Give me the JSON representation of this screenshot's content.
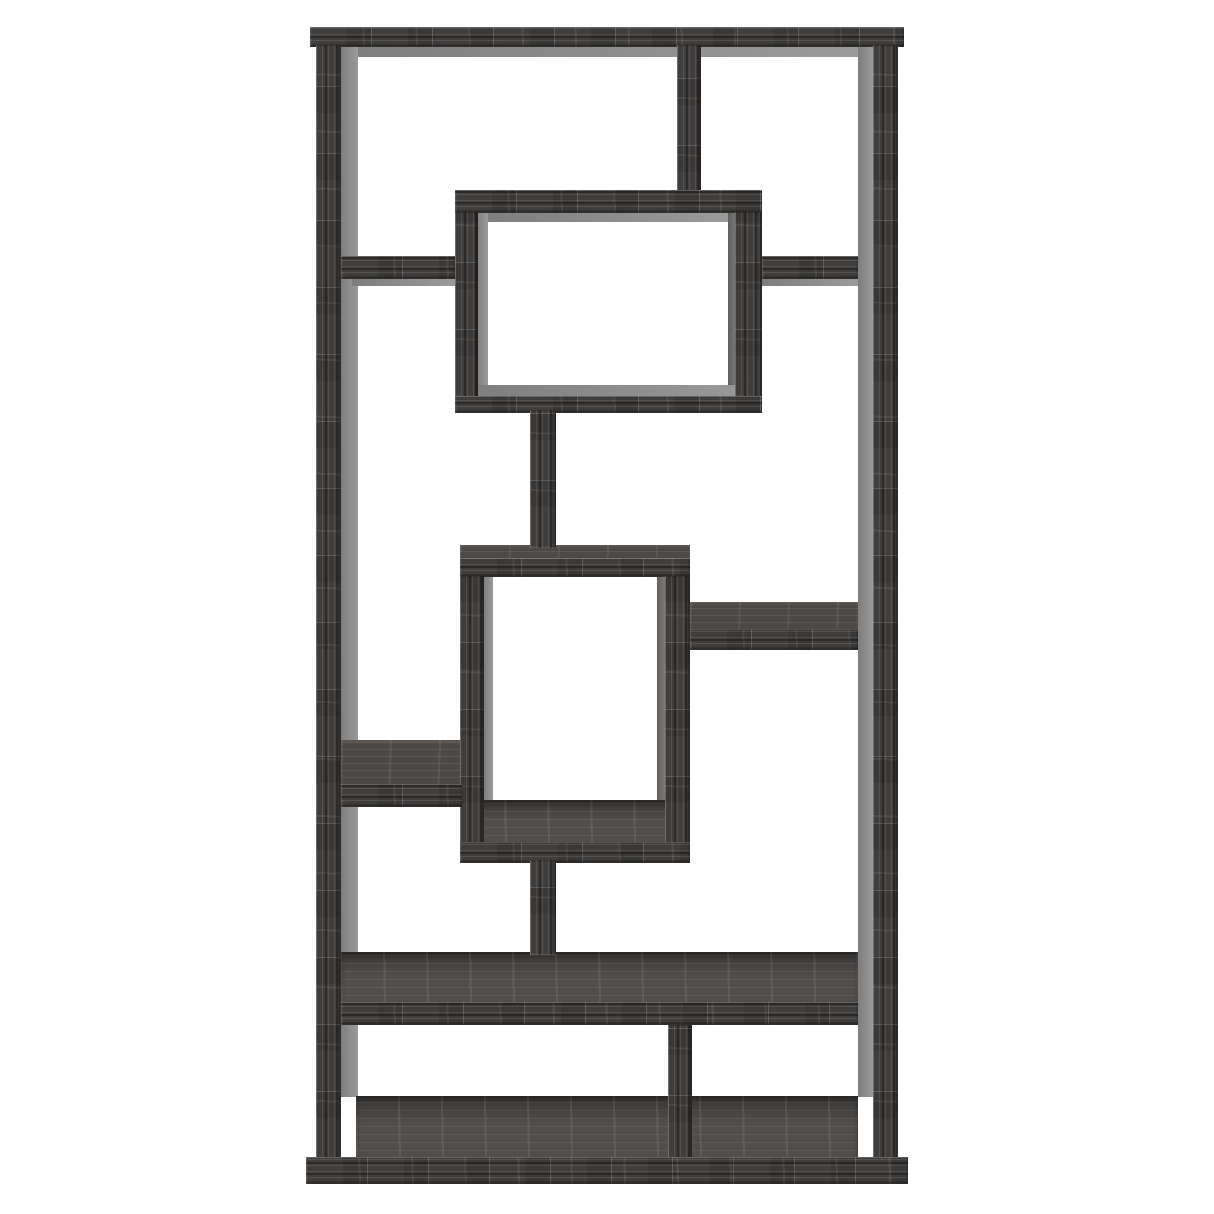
{
  "meta": {
    "subject": "geometric-10-shelf-bookcase-product-photo",
    "finish": "weathered-grey-wood",
    "background": "#ffffff"
  },
  "palette": {
    "wood_dark": "#403e3c",
    "wood_mid": "#4b4846",
    "floor_tone": "#504d4b",
    "edge_gray": "#8f8f8f",
    "edge_gray_dark": "#767472",
    "background": "#ffffff"
  },
  "canvas": {
    "width": 1214,
    "height": 1214
  },
  "parts": [
    {
      "name": "top-board-underside",
      "face": "edge",
      "x": 341,
      "y": 45,
      "w": 517,
      "h": 12
    },
    {
      "name": "left-post-inner-face",
      "face": "edge",
      "x": 341,
      "y": 47,
      "w": 17,
      "h": 1050
    },
    {
      "name": "right-post-inner-face",
      "face": "edge",
      "x": 858,
      "y": 47,
      "w": 15,
      "h": 1050
    },
    {
      "name": "upper-box-top-underside",
      "face": "edge",
      "x": 478,
      "y": 212,
      "w": 252,
      "h": 10
    },
    {
      "name": "upper-box-left-inner-face",
      "face": "edge",
      "x": 476,
      "y": 213,
      "w": 12,
      "h": 180
    },
    {
      "name": "upper-box-right-inner-face",
      "face": "edge-dark",
      "x": 728,
      "y": 213,
      "w": 9,
      "h": 180
    },
    {
      "name": "upper-box-bottom-inner-face",
      "face": "edge",
      "x": 470,
      "y": 385,
      "w": 284,
      "h": 12
    },
    {
      "name": "left-top-shelf-underside",
      "face": "edge",
      "x": 352,
      "y": 278,
      "w": 103,
      "h": 8
    },
    {
      "name": "right-top-shelf-underside",
      "face": "edge",
      "x": 762,
      "y": 278,
      "w": 96,
      "h": 8
    },
    {
      "name": "middle-box-left-inner-face",
      "face": "edge",
      "x": 484,
      "y": 577,
      "w": 9,
      "h": 228
    },
    {
      "name": "middle-box-right-inner-face",
      "face": "edge-dark",
      "x": 657,
      "y": 577,
      "w": 8,
      "h": 228
    },
    {
      "name": "left-mid-shelf-underside",
      "face": "edge",
      "x": 352,
      "y": 793,
      "w": 110,
      "h": 8
    },
    {
      "name": "middle-box-top-face",
      "face": "top",
      "x": 460,
      "y": 545,
      "w": 230,
      "h": 14
    },
    {
      "name": "right-mid-shelf-top-face",
      "face": "top",
      "x": 690,
      "y": 602,
      "w": 168,
      "h": 28
    },
    {
      "name": "left-mid-shelf-top-face",
      "face": "top",
      "x": 341,
      "y": 740,
      "w": 121,
      "h": 45
    },
    {
      "name": "middle-box-floor",
      "face": "floor",
      "x": 462,
      "y": 800,
      "w": 226,
      "h": 44
    },
    {
      "name": "long-shelf-top-face",
      "face": "floor",
      "x": 341,
      "y": 952,
      "w": 517,
      "h": 52
    },
    {
      "name": "base-top-face",
      "face": "floor",
      "x": 356,
      "y": 1096,
      "w": 502,
      "h": 63
    },
    {
      "name": "top-board",
      "face": "front-h",
      "x": 310,
      "y": 27,
      "w": 594,
      "h": 20
    },
    {
      "name": "left-post",
      "face": "front-v",
      "x": 316,
      "y": 45,
      "w": 25,
      "h": 1114
    },
    {
      "name": "right-post",
      "face": "front-v",
      "x": 873,
      "y": 45,
      "w": 25,
      "h": 1114
    },
    {
      "name": "top-divider",
      "face": "front-v",
      "x": 677,
      "y": 45,
      "w": 24,
      "h": 168
    },
    {
      "name": "upper-box-top-board",
      "face": "front-h",
      "x": 455,
      "y": 190,
      "w": 307,
      "h": 23
    },
    {
      "name": "upper-box-left-side",
      "face": "front-v",
      "x": 455,
      "y": 212,
      "w": 23,
      "h": 185
    },
    {
      "name": "upper-box-right-side",
      "face": "front-v",
      "x": 735,
      "y": 212,
      "w": 27,
      "h": 185
    },
    {
      "name": "upper-box-bottom-board",
      "face": "front-h",
      "x": 455,
      "y": 396,
      "w": 307,
      "h": 17
    },
    {
      "name": "left-top-shelf",
      "face": "front-h",
      "x": 341,
      "y": 256,
      "w": 114,
      "h": 23
    },
    {
      "name": "right-top-shelf",
      "face": "front-h",
      "x": 762,
      "y": 256,
      "w": 96,
      "h": 23
    },
    {
      "name": "upper-stem",
      "face": "front-v",
      "x": 530,
      "y": 410,
      "w": 26,
      "h": 138
    },
    {
      "name": "middle-box-top-front",
      "face": "front-h",
      "x": 460,
      "y": 558,
      "w": 230,
      "h": 19
    },
    {
      "name": "middle-box-left-side",
      "face": "front-v",
      "x": 460,
      "y": 576,
      "w": 24,
      "h": 268
    },
    {
      "name": "middle-box-right-side",
      "face": "front-v",
      "x": 665,
      "y": 576,
      "w": 25,
      "h": 268
    },
    {
      "name": "middle-box-bottom-front",
      "face": "front-h",
      "x": 460,
      "y": 842,
      "w": 230,
      "h": 21
    },
    {
      "name": "right-mid-shelf-front",
      "face": "front-h",
      "x": 690,
      "y": 629,
      "w": 168,
      "h": 21
    },
    {
      "name": "left-mid-shelf-front",
      "face": "front-h",
      "x": 341,
      "y": 784,
      "w": 121,
      "h": 23
    },
    {
      "name": "lower-stem",
      "face": "front-v",
      "x": 530,
      "y": 860,
      "w": 26,
      "h": 95
    },
    {
      "name": "long-shelf-front",
      "face": "front-h",
      "x": 341,
      "y": 1002,
      "w": 517,
      "h": 23
    },
    {
      "name": "bottom-divider",
      "face": "front-v",
      "x": 668,
      "y": 1025,
      "w": 24,
      "h": 138
    },
    {
      "name": "base-front",
      "face": "front-h",
      "x": 306,
      "y": 1157,
      "w": 602,
      "h": 27
    }
  ]
}
